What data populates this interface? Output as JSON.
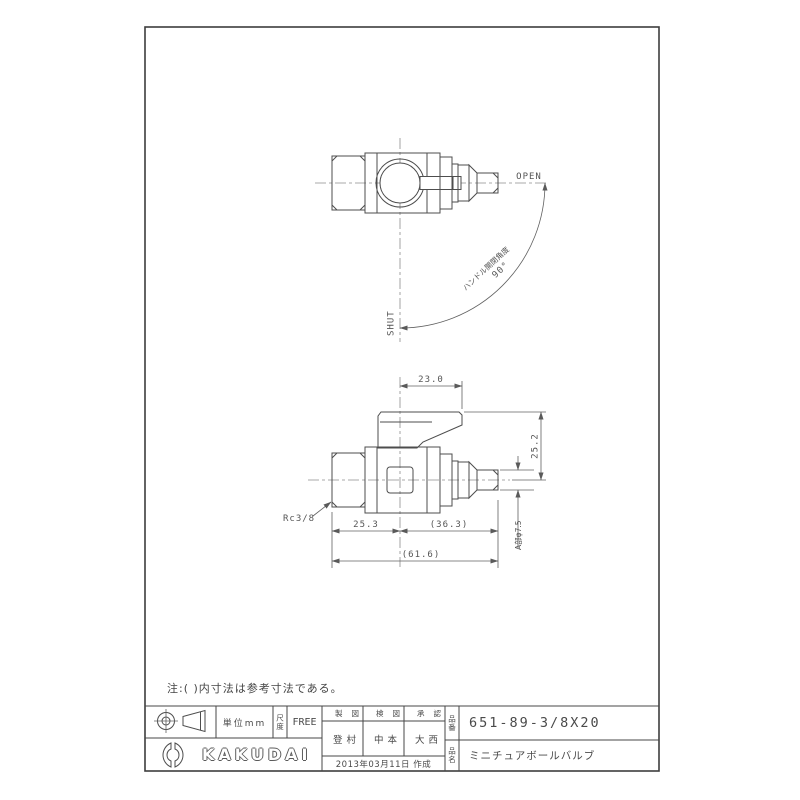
{
  "colors": {
    "ink": "#4d4d4d",
    "paper": "#ffffff"
  },
  "note": "注:( )内寸法は参考寸法である。",
  "top_view": {
    "open_label": "OPEN",
    "shut_label": "SHUT",
    "arc_label": "ハンドル開閉角度",
    "arc_angle": "90°"
  },
  "front_view": {
    "dim_handle_length": "23.0",
    "dim_handle_height": "25.2",
    "dim_tube_dia": "A部φ7.5",
    "dim_left": "25.3",
    "dim_right": "(36.3)",
    "dim_overall": "(61.6)",
    "thread_label": "Rc3/8"
  },
  "title_block": {
    "unit": "単位mm",
    "scale_label": "尺度",
    "scale_value": "FREE",
    "columns": {
      "drafted": "製図",
      "checked": "検図",
      "approved": "承認"
    },
    "signers": {
      "drafted": "登村",
      "checked": "中本",
      "approved": "大西"
    },
    "date": "2013年03月11日 作成",
    "part_no_label": "品番",
    "part_no": "651-89-3/8X20",
    "name_label": "品名",
    "product_name": "ミニチュアボールバルブ",
    "brand": "KAKUDAI"
  }
}
